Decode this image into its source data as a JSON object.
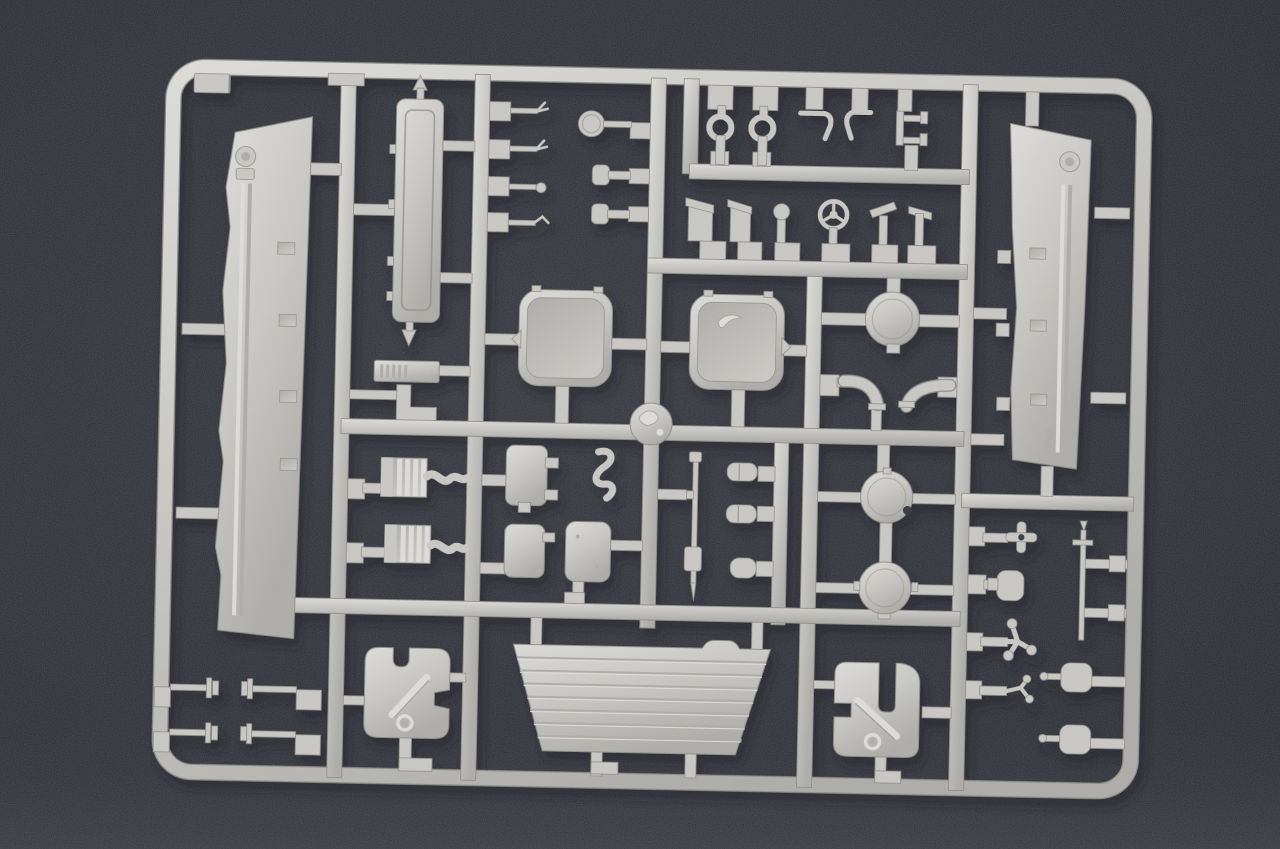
{
  "scene": {
    "type": "photograph",
    "subject": "plastic model kit sprue",
    "description": "Light grey injection-moulded model kit sprue (parts tree) with tank detail parts, photographed on a dark grey felt background",
    "visible_text": ""
  },
  "palette": {
    "bg_deep": "#30343f",
    "bg_mid": "#3e434f",
    "bg_soft": "#4a4f5a",
    "bg_low": "#585d66",
    "bg_hole": "#3a3f49",
    "plastic": "#c8c7c3",
    "plastic_hi": "#dcdbd7",
    "plastic_lo": "#aeada9",
    "plastic_edge": "#908f89",
    "shadow": "#1d212b"
  },
  "sprue": {
    "material": "light grey polystyrene",
    "frame_shape": "rounded rectangle with internal runner grid",
    "parts_inventory": [
      {
        "name": "side skirt armour panel",
        "count": 2
      },
      {
        "name": "long hull side panel",
        "count": 1
      },
      {
        "name": "rectangular crew hatch",
        "count": 2
      },
      {
        "name": "small access hatch",
        "count": 2
      },
      {
        "name": "equipment box",
        "count": 1
      },
      {
        "name": "circular engine cover",
        "count": 1
      },
      {
        "name": "round wheel disc",
        "count": 2
      },
      {
        "name": "round medallion disc",
        "count": 2
      },
      {
        "name": "louvered intake grille",
        "count": 2
      },
      {
        "name": "ribbed glacis plate",
        "count": 1
      },
      {
        "name": "bracket plate with hole",
        "count": 2
      },
      {
        "name": "towing shackle",
        "count": 2
      },
      {
        "name": "bent wire hook",
        "count": 2
      },
      {
        "name": "clamp bracket",
        "count": 1
      },
      {
        "name": "periscope head",
        "count": 3
      },
      {
        "name": "three-spoke steering wheel",
        "count": 1
      },
      {
        "name": "antenna base",
        "count": 2
      },
      {
        "name": "antenna rod",
        "count": 2
      },
      {
        "name": "elbow pipe",
        "count": 2
      },
      {
        "name": "cross fitting",
        "count": 1
      },
      {
        "name": "branch fitting",
        "count": 2
      },
      {
        "name": "plug fitting",
        "count": 3
      },
      {
        "name": "winged pin fitting",
        "count": 4
      },
      {
        "name": "flanged needle pin",
        "count": 4
      }
    ]
  }
}
